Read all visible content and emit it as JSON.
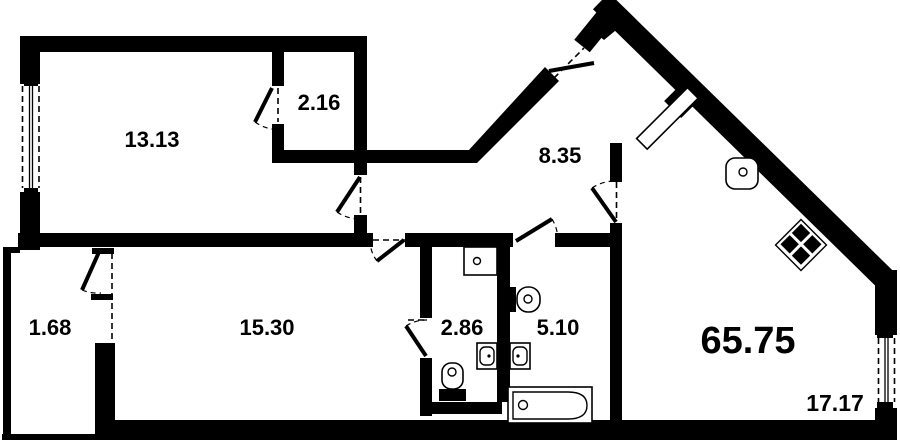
{
  "plan": {
    "type": "apartment floor plan",
    "wall_color": "#000000",
    "background_color": "#ffffff",
    "total_area": "65.75",
    "rooms": {
      "bedroom": {
        "area": "13.13"
      },
      "wardrobe": {
        "area": "2.16"
      },
      "hallway": {
        "area": "8.35"
      },
      "loggia": {
        "area": "1.68"
      },
      "living_room": {
        "area": "15.30"
      },
      "wc": {
        "area": "2.86"
      },
      "bathroom": {
        "area": "5.10"
      },
      "kitchen_living_room": {
        "area": "17.17"
      }
    },
    "fixtures": [
      "window",
      "entrance-door",
      "interior-door",
      "bathtub",
      "toilet",
      "sink",
      "washing-machine",
      "stove",
      "ventilation-shaft"
    ]
  }
}
